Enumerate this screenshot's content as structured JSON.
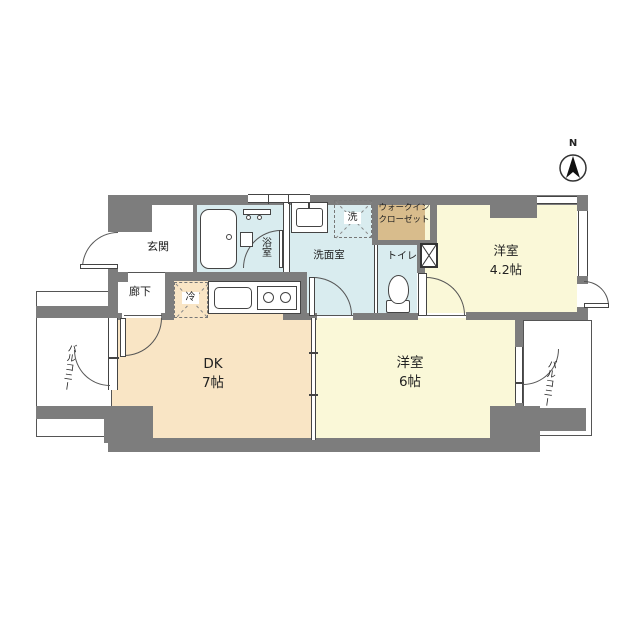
{
  "compass": {
    "north_label": "N"
  },
  "rooms": {
    "genkan": {
      "label": "玄関"
    },
    "rouka": {
      "label": "廊下"
    },
    "yokushitsu": {
      "label": "浴室"
    },
    "senmenshitsu": {
      "label": "洗面室"
    },
    "toilet": {
      "label": "トイレ"
    },
    "walk_in_closet": {
      "line1": "ウォークイン",
      "line2": "クローゼット"
    },
    "western_room_42": {
      "label": "洋室",
      "size": "4.2帖"
    },
    "dining_kitchen": {
      "label": "DK",
      "size": "7帖"
    },
    "western_room_6": {
      "label": "洋室",
      "size": "6帖"
    },
    "balcony_left": {
      "label": "バルコニー"
    },
    "balcony_right": {
      "label": "バルコニー"
    }
  },
  "fixtures": {
    "refrigerator": {
      "label": "冷"
    },
    "washing_machine": {
      "label": "洗"
    }
  },
  "colors": {
    "wall": "#7d7d7d",
    "western_room_floor": "#faf8d8",
    "dining_kitchen_floor": "#f9e5c5",
    "wet_area_floor": "#d9ecef",
    "closet_floor": "#d8bc8c",
    "line": "#444444"
  }
}
